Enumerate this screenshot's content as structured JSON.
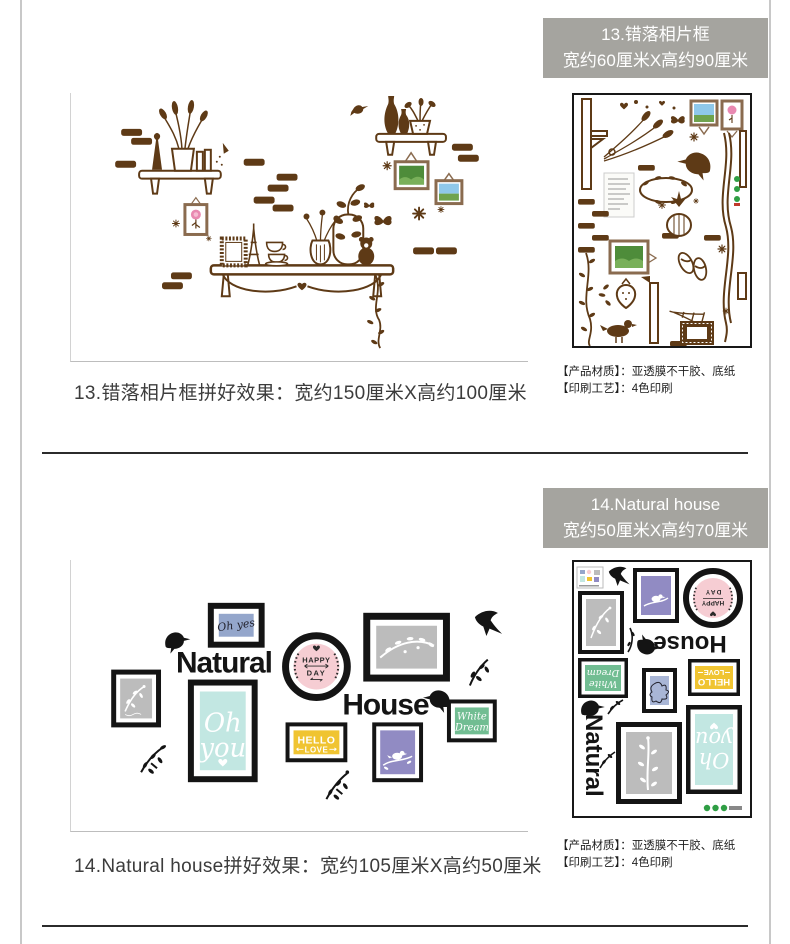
{
  "colors": {
    "header_bg": "#a5a49f",
    "header_text": "#ffffff",
    "caption_text": "#3c3c3c",
    "divider": "#2b2b2b",
    "page_edge": "#c8c8c8",
    "decal_brown": "#5e3a16",
    "frame_black": "#141414",
    "badge_pink": "#f6cdd3",
    "mint": "#c2e7e2",
    "yellow": "#f0c431",
    "purple": "#918bc3",
    "slate_blue": "#94a6cb",
    "photo_gray": "#bcbcbc",
    "green": "#71bd92",
    "cert_green": "#2f9e44"
  },
  "section13": {
    "header": {
      "line1": "13.错落相片框",
      "line2": "宽约60厘米X高约90厘米"
    },
    "caption": "13.错落相片框拼好效果：宽约150厘米X高约100厘米",
    "materials": {
      "line1": "【产品材质】：亚透膜不干胶、底纸",
      "line2": "【印刷工艺】：4色印刷"
    }
  },
  "section14": {
    "header": {
      "line1": "14.Natural house",
      "line2": "宽约50厘米X高约70厘米"
    },
    "caption": "14.Natural house拼好效果：宽约105厘米X高约50厘米",
    "materials": {
      "line1": "【产品材质】：亚透膜不干胶、底纸",
      "line2": "【印刷工艺】：4色印刷"
    },
    "artwork": {
      "word_natural": "Natural",
      "word_house": "House",
      "badge_happy": "HAPPY",
      "badge_day": "DAY",
      "frame_ohyes": "Oh yes",
      "frame_oh": "Oh",
      "frame_you": "you",
      "frame_hello": "HELLO",
      "frame_love": "LOVE",
      "frame_white": "White",
      "frame_dream": "Dream"
    }
  }
}
